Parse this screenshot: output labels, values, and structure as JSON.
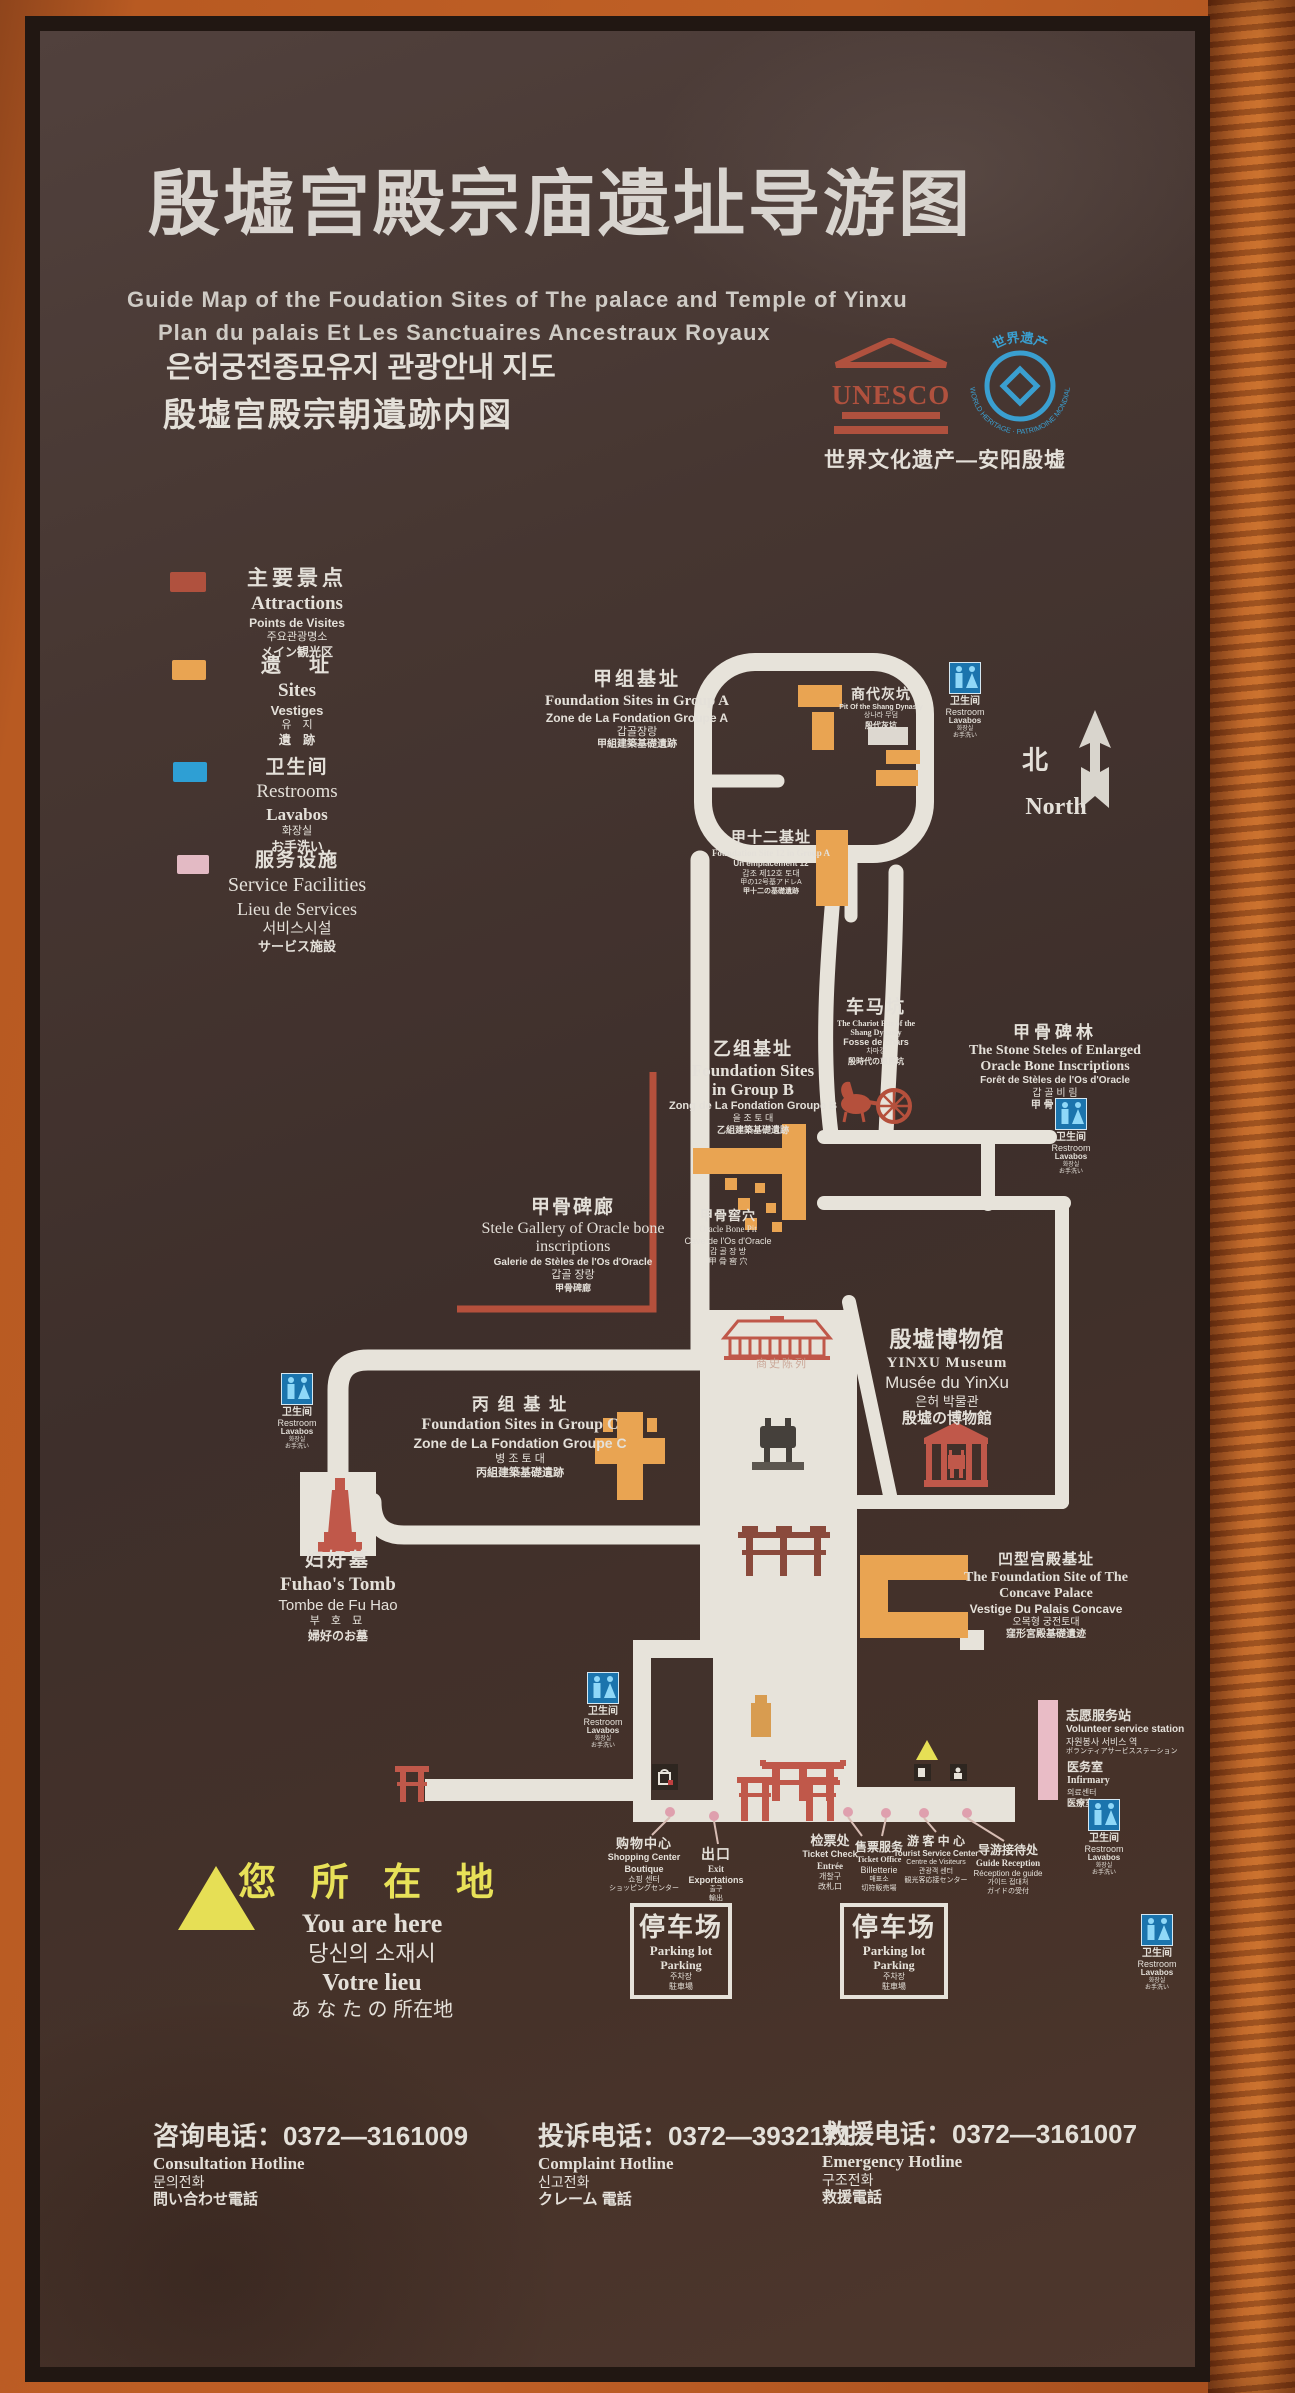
{
  "header": {
    "title_zh": "殷墟宫殿宗庙遗址导游图",
    "title_en": "Guide Map of the Foudation Sites of The palace and Temple of Yinxu",
    "title_fr": "Plan du palais Et Les Sanctuaires Ancestraux Royaux",
    "title_ko": "은허궁전종묘유지 관광안내 지도",
    "title_ja": "殷墟宫殿宗朝遺跡内図",
    "unesco_word": "UNESCO",
    "wh_zh": "世界遗产",
    "wh_ring": "WORLD HERITAGE · PATRIMOINE MONDIAL",
    "heritage_caption": "世界文化遗产—安阳殷墟"
  },
  "legend": {
    "attractions": {
      "color": "#b0513e",
      "zh": "主要景点",
      "en": "Attractions",
      "fr": "Points de Visites",
      "ko": "주요관광명소",
      "ja": "メイン観光区"
    },
    "sites": {
      "color": "#e9a452",
      "zh": "遗　址",
      "en": "Sites",
      "fr": "Vestiges",
      "ko": "유　지",
      "ja": "遺　跡"
    },
    "restrooms": {
      "color": "#2e9fd4",
      "zh": "卫生间",
      "en": "Restrooms",
      "fr": "Lavabos",
      "ko": "화장실",
      "ja": "お手洗い"
    },
    "service": {
      "color": "#e3bac4",
      "zh": "服务设施",
      "en": "Service Facilities",
      "fr": "Lieu de Services",
      "ko": "서비스시설",
      "ja": "サービス施設"
    }
  },
  "north": {
    "zh": "北",
    "en": "North"
  },
  "wc": {
    "zh": "卫生间",
    "en": "Restroom",
    "fr": "Lavabos",
    "ko": "화장실",
    "ja": "お手洗い"
  },
  "map": {
    "group_a": {
      "zh": "甲组基址",
      "en": "Foundation Sites in Group A",
      "fr": "Zone de La Fondation Groupe A",
      "ko": "갑골장랑",
      "ja": "甲組建築基礎遺跡"
    },
    "shang_pit": {
      "zh": "商代灰坑",
      "en": "Pit Of the Shang Dynasty",
      "ko": "상나라 무덤",
      "ja": "殷代灰坑"
    },
    "jia12": {
      "zh": "甲十二基址",
      "en": "Foundation Site 12 in Group A",
      "fr": "Un emplacement 12",
      "ko": "갑조 제12호 토대",
      "ja": "甲の12号基アドレA",
      "ja2": "甲十二の基礎遺跡"
    },
    "chariot": {
      "zh": "车马坑",
      "en": "The Chariot Pits of the Shang Dynasty",
      "fr": "Fosse de chars",
      "ko": "차마갱",
      "ja": "殷時代の車馬坑"
    },
    "steles": {
      "zh": "甲骨碑林",
      "en": "The Stone Steles of Enlarged Oracle Bone Inscriptions",
      "fr": "Forêt de Stèles de l'Os d'Oracle",
      "ko": "갑 골 비 림",
      "ja": "甲 骨 碑 林"
    },
    "group_b": {
      "zh": "乙组基址",
      "en": "Foundation Sites in Group B",
      "fr": "Zong de La Fondation Groupe B",
      "ko": "을 조 토 대",
      "ja": "乙組建築基礎遺跡"
    },
    "oracle_pit": {
      "zh": "甲骨窖穴",
      "en": "Oracle Bone Pit",
      "fr": "Cave de l'Os d'Oracle",
      "ko": "갑 골 장 방",
      "ja": "甲 骨 窖 穴"
    },
    "stele_gallery": {
      "zh": "甲骨碑廊",
      "en": "Stele Gallery of Oracle bone inscriptions",
      "fr": "Galerie de Stèles de l'Os d'Oracle",
      "ko": "갑골 장랑",
      "ja": "甲骨碑廊"
    },
    "museum": {
      "zh": "殷墟博物馆",
      "en": "YINXU Museum",
      "fr": "Musée du YinXu",
      "ko": "은허 박물관",
      "ja": "殷墟の博物館"
    },
    "group_c": {
      "zh": "丙 组 基 址",
      "en": "Foundation Sites in Group C",
      "fr": "Zone de La Fondation Groupe C",
      "ko": "병 조 토 대",
      "ja": "丙組建築基礎遺跡"
    },
    "fuhao": {
      "zh": "妇好墓",
      "en": "Fuhao's Tomb",
      "fr": "Tombe de Fu Hao",
      "ko": "부 호 묘",
      "ja": "婦好のお墓"
    },
    "concave": {
      "zh": "凹型宫殿基址",
      "en": "The Foundation Site of The Concave Palace",
      "fr": "Vestige Du Palais Concave",
      "ko": "오목형 궁전토대",
      "ja": "窪形宮殿基礎遺迹"
    },
    "hall": {
      "zh": "商史陈列"
    }
  },
  "services": {
    "volunteer": {
      "zh": "志愿服务站",
      "en": "Volunteer service station",
      "ko": "자원봉사 서비스 역",
      "ja": "ボランティアサービスステーション"
    },
    "infirmary": {
      "zh": "医务室",
      "en": "Infirmary",
      "ko": "의료센터",
      "ja": "医療室"
    },
    "shopping": {
      "zh": "购物中心",
      "en": "Shopping Center",
      "fr": "Boutique",
      "ko": "쇼핑 센터",
      "ja": "ショッピングセンター"
    },
    "exit": {
      "zh": "出口",
      "en": "Exit",
      "fr": "Exportations",
      "ko": "출구",
      "ja": "輸出"
    },
    "ticket_check": {
      "zh": "检票处",
      "en": "Ticket Check",
      "fr": "Entrée",
      "ko": "개찰구",
      "ja": "改札口"
    },
    "ticket_office": {
      "zh": "售票服务",
      "en": "Ticket Office",
      "fr": "Billetterie",
      "ko": "매표소",
      "ja": "切符販売場"
    },
    "tourist_center": {
      "zh": "游 客 中 心",
      "en": "Tourist Service Center",
      "fr": "Centre de Visiteurs",
      "ko": "관광객 센터",
      "ja": "観光客応接センター"
    },
    "guide_reception": {
      "zh": "导游接待处",
      "en": "Guide Reception",
      "fr": "Réception de guide",
      "ko": "가이드 접대처",
      "ja": "ガイドの受付"
    },
    "parking": {
      "zh": "停车场",
      "en": "Parking lot",
      "en2": "Parking",
      "ko": "주차장",
      "ja": "駐車場"
    }
  },
  "you_are_here": {
    "zh": "您 所 在 地",
    "en": "You are here",
    "ko": "당신의  소재시",
    "fr": "Votre lieu",
    "ja": "あ な た の 所在地"
  },
  "hotlines": {
    "consultation": {
      "zh": "咨询电话：0372—3161009",
      "en": "Consultation Hotline",
      "ko": "문의전화",
      "ja": "問い合わせ電話"
    },
    "complaint": {
      "zh": "投诉电话：0372—3932171",
      "en": "Complaint Hotline",
      "ko": "신고전화",
      "ja": "クレーム 電話"
    },
    "emergency": {
      "zh": "救援电话：0372—3161007",
      "en": "Emergency Hotline",
      "ko": "구조전화",
      "ja": "救援電話"
    }
  }
}
